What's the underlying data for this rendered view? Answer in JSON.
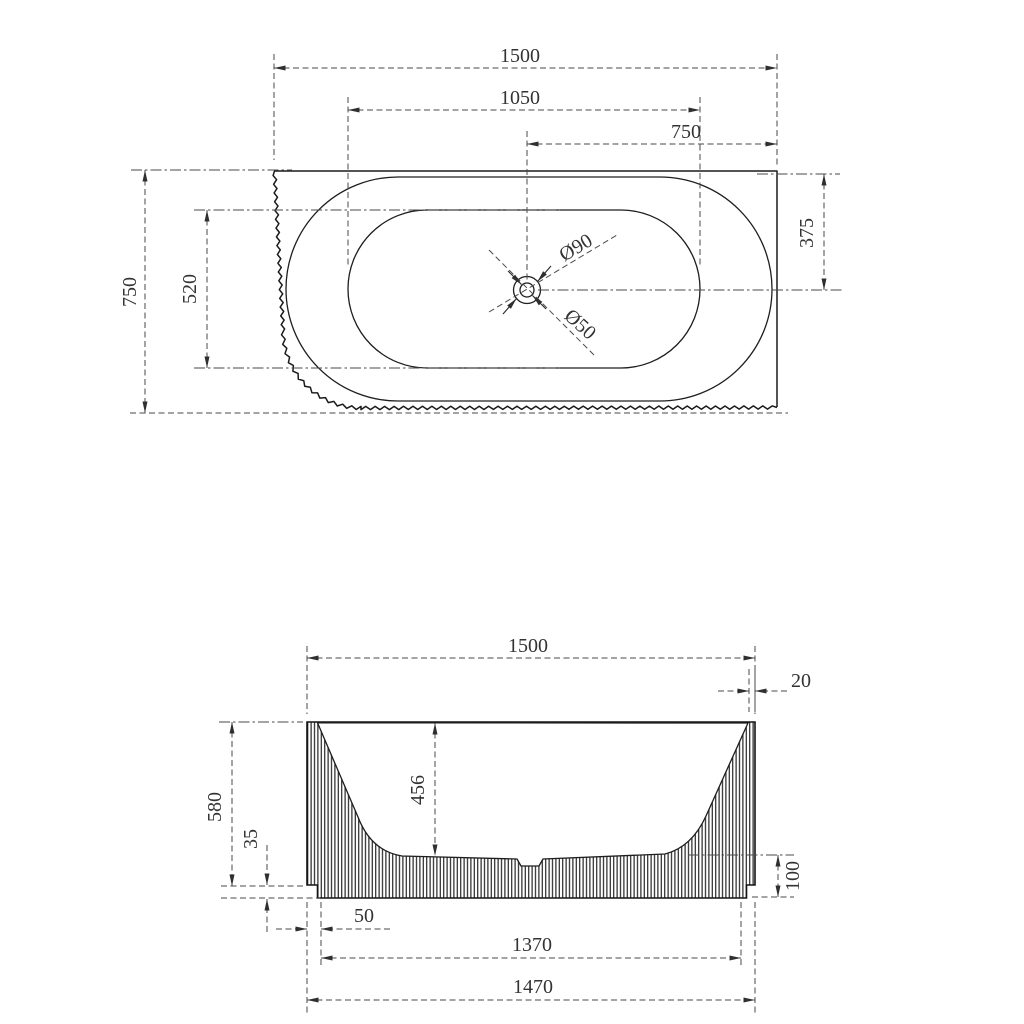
{
  "title": "Bathtub dimension drawing",
  "plan": {
    "dims": {
      "overall_width": "1500",
      "basin_length": "1050",
      "drain_to_right": "750",
      "overall_depth": "750",
      "basin_width": "520",
      "drain_offset": "375",
      "drain_flange": "Ø90",
      "drain_waste": "Ø50"
    }
  },
  "front": {
    "dims": {
      "overall_width": "1500",
      "rim_thickness": "20",
      "overall_height": "580",
      "basin_depth": "456",
      "plinth_step": "35",
      "base_height": "100",
      "base_inset": "50",
      "base_width": "1370",
      "lower_width": "1470"
    }
  },
  "colors": {
    "line": "#1b1b1b",
    "dim": "#4a4a4a",
    "background": "#ffffff"
  }
}
